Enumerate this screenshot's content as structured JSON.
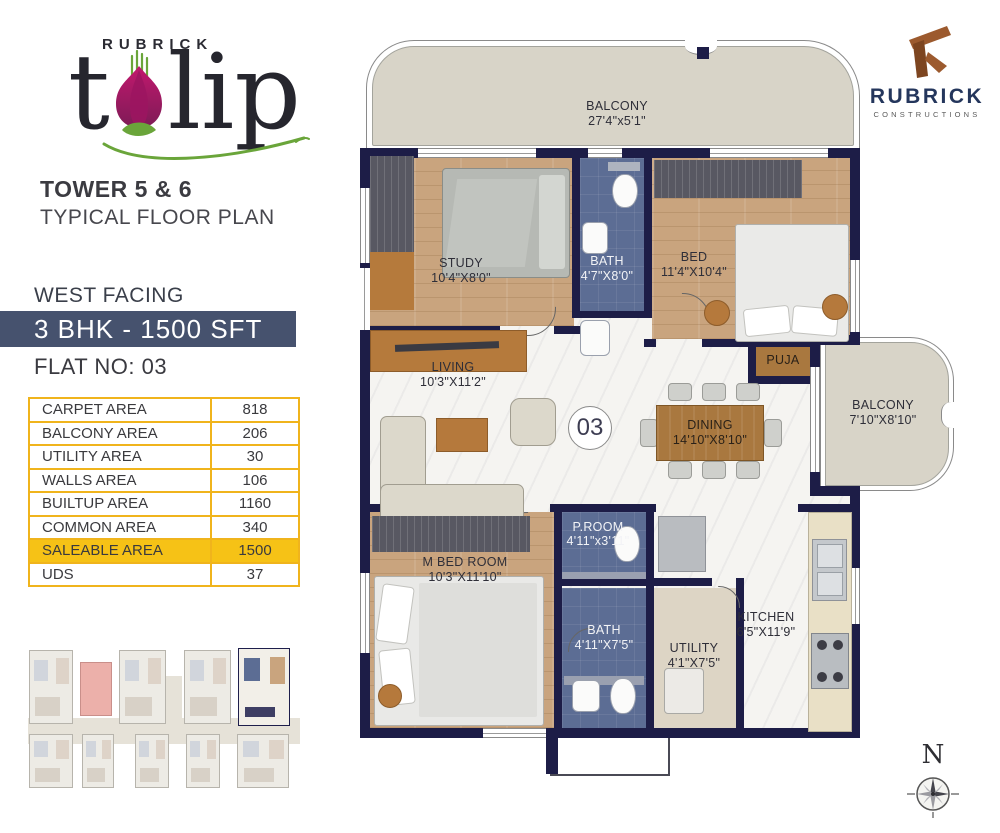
{
  "branding": {
    "project_top": "RUBRICK",
    "project_t": "t",
    "project_lip": "lip",
    "tower": "TOWER 5 & 6",
    "plan_type": "TYPICAL FLOOR PLAN",
    "builder": {
      "name": "RUBRICK",
      "tagline": "CONSTRUCTIONS"
    }
  },
  "unit": {
    "facing": "WEST FACING",
    "config": "3 BHK - 1500 SFT",
    "flat_no": "FLAT NO: 03",
    "number": "03"
  },
  "area_table": {
    "rows": [
      {
        "label": "CARPET AREA",
        "value": "818"
      },
      {
        "label": "BALCONY AREA",
        "value": "206"
      },
      {
        "label": "UTILITY AREA",
        "value": "30"
      },
      {
        "label": "WALLS AREA",
        "value": "106"
      },
      {
        "label": "BUILTUP AREA",
        "value": "1160"
      },
      {
        "label": "COMMON AREA",
        "value": "340"
      },
      {
        "label": "SALEABLE AREA",
        "value": "1500"
      },
      {
        "label": "UDS",
        "value": "37"
      }
    ]
  },
  "floor_plan": {
    "unit_number": "03",
    "compass_label": "N",
    "rooms": {
      "balcony_top": {
        "name": "BALCONY",
        "size": "27'4\"x5'1\""
      },
      "study": {
        "name": "STUDY",
        "size": "10'4\"X8'0\""
      },
      "bath_top": {
        "name": "BATH",
        "size": "4'7\"X8'0\""
      },
      "bed": {
        "name": "BED",
        "size": "11'4\"X10'4\""
      },
      "living": {
        "name": "LIVING",
        "size": "10'3\"X11'2\""
      },
      "puja": {
        "name": "PUJA"
      },
      "dining": {
        "name": "DINING",
        "size": "14'10\"X8'10\""
      },
      "balcony_right": {
        "name": "BALCONY",
        "size": "7'10\"X8'10\""
      },
      "m_bed": {
        "name": "M BED ROOM",
        "size": "10'3\"X11'10\""
      },
      "p_room": {
        "name": "P.ROOM",
        "size": "4'11\"x3'11\""
      },
      "bath_bottom": {
        "name": "BATH",
        "size": "4'11\"X7'5\""
      },
      "utility": {
        "name": "UTILITY",
        "size": "4'1\"X7'5\""
      },
      "kitchen": {
        "name": "KITCHEN",
        "size": "6'5\"X11'9\""
      }
    }
  },
  "colors": {
    "wall_navy": "#1D1D47",
    "band_navy": "#46526E",
    "table_border_yellow": "#F0B41C",
    "highlight_yellow": "#F6C216",
    "tulip_magenta": "#B0176B",
    "leaf_green": "#6AA53A",
    "builder_brown": "#9C5A2E"
  }
}
